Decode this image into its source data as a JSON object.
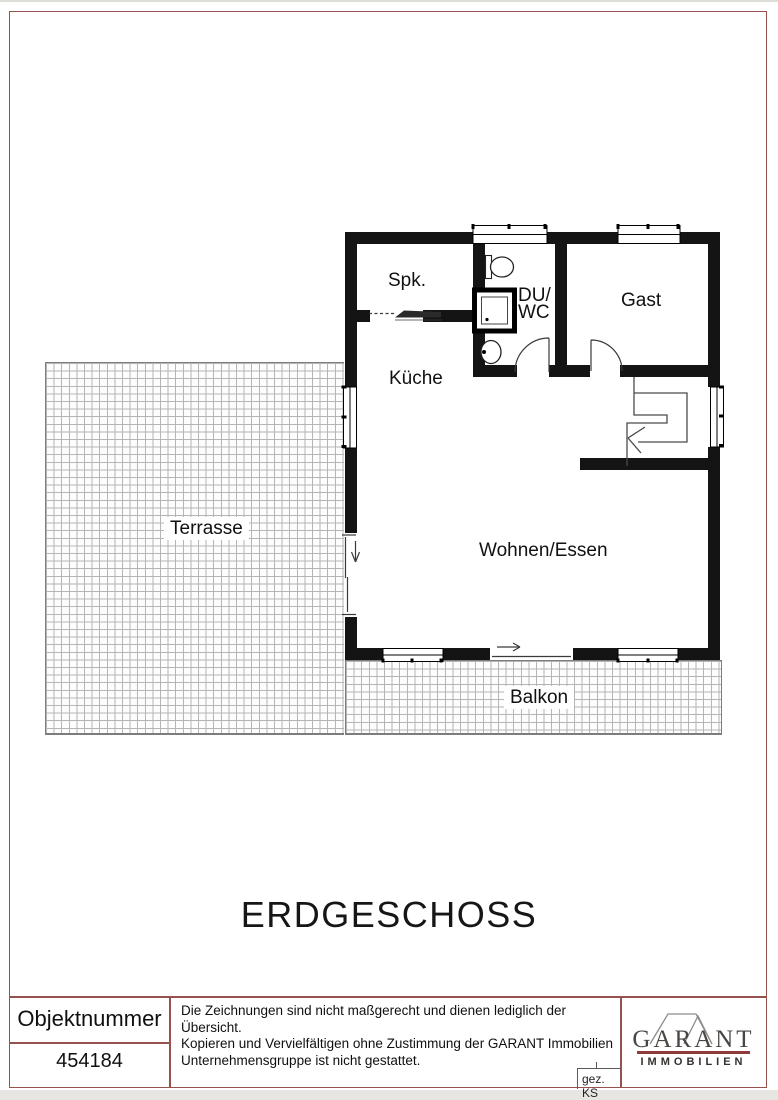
{
  "document": {
    "floor_title": "ERDGESCHOSS"
  },
  "plan": {
    "labels": {
      "spk": "Spk.",
      "du_wc_line1": "DU/",
      "du_wc_line2": "WC",
      "gast": "Gast",
      "kueche": "Küche",
      "wohnen_essen": "Wohnen/Essen",
      "terrasse": "Terrasse",
      "balkon": "Balkon"
    },
    "symbols": {
      "stairs": "stairs-with-down-arrow",
      "toilet": "wc-toilet",
      "shower": "shower-tray",
      "washbasin": "washbasin",
      "swing_doors": "quarter-circle-door-arcs",
      "sliding_doors": "sliding-door-arrows",
      "windows": "double-line-window-symbols"
    }
  },
  "footer": {
    "object_number_label": "Objektnummer",
    "object_number_value": "454184",
    "disclaimer_lines": [
      "Die Zeichnungen sind nicht maßgerecht und dienen lediglich der Übersicht.",
      "Kopieren und Vervielfältigen ohne Zustimmung der GARANT Immobilien",
      "Unternehmensgruppe ist nicht gestattet."
    ],
    "drawn_by": "gez. KS",
    "logo": {
      "brand": "GARANT",
      "subline": "IMMOBILIEN"
    }
  },
  "colors": {
    "frame_red": "#96524e",
    "wall_black": "#141414",
    "logo_rule_red": "#8e3a38",
    "hatch_grid_gray": "#b5b5b5"
  }
}
